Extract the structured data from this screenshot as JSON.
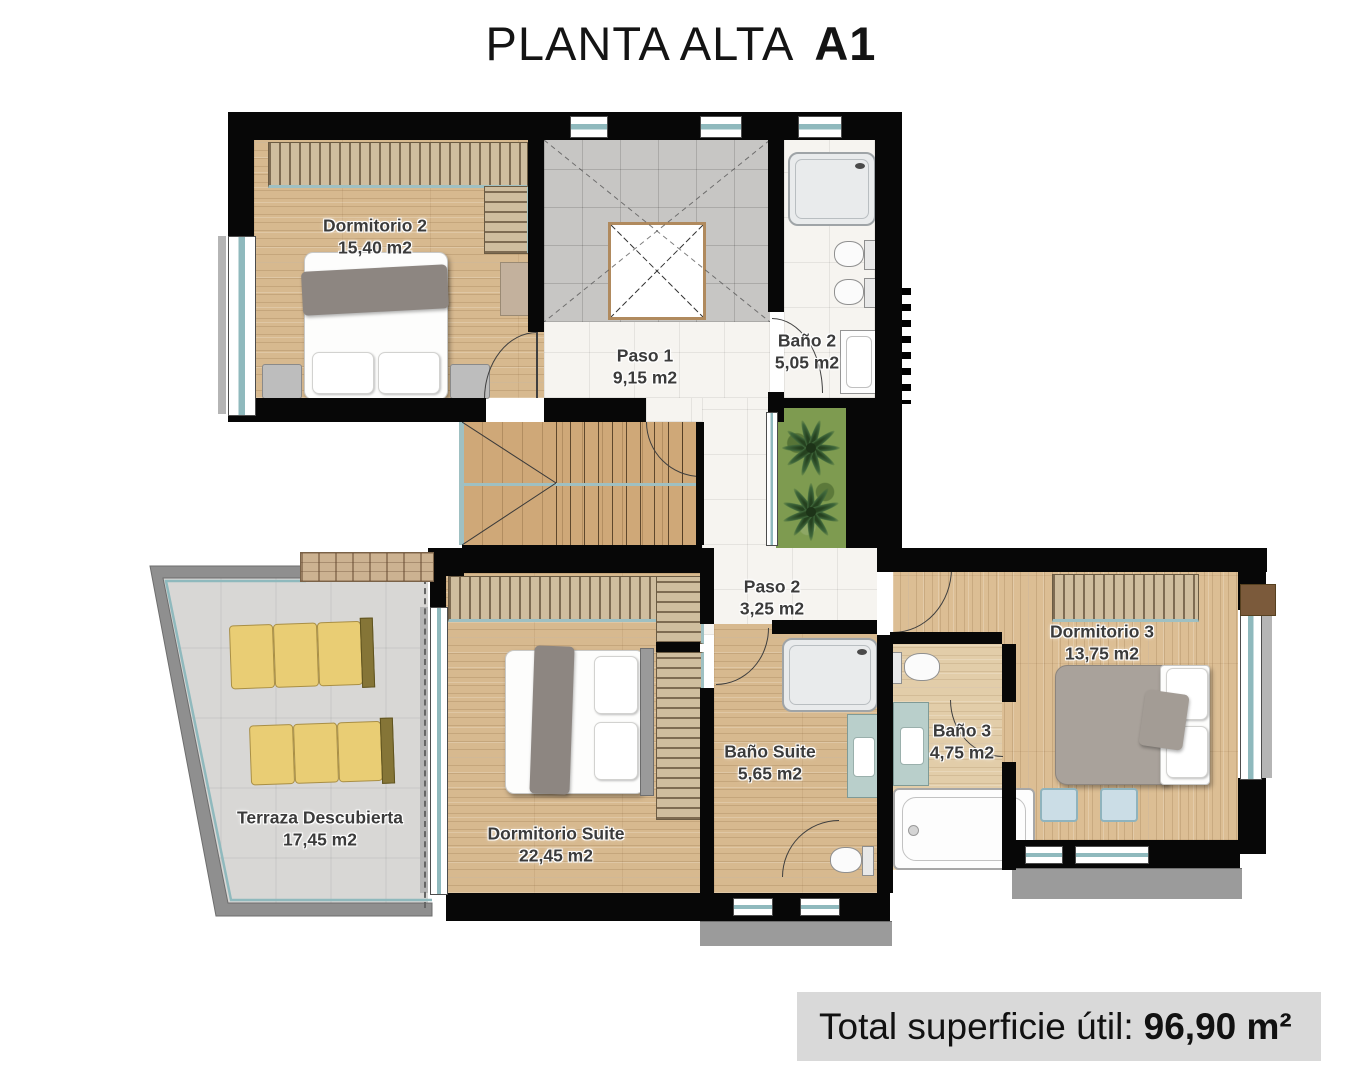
{
  "title": {
    "main": "PLANTA ALTA",
    "code": "A1"
  },
  "rooms": {
    "dormitorio2": {
      "name": "Dormitorio 2",
      "area": "15,40 m2"
    },
    "paso1": {
      "name": "Paso 1",
      "area": "9,15 m2"
    },
    "bano2": {
      "name": "Baño 2",
      "area": "5,05 m2"
    },
    "paso2": {
      "name": "Paso 2",
      "area": "3,25 m2"
    },
    "dormitorio3": {
      "name": "Dormitorio 3",
      "area": "13,75 m2"
    },
    "banoSuite": {
      "name": "Baño Suite",
      "area": "5,65 m2"
    },
    "bano3": {
      "name": "Baño 3",
      "area": "4,75 m2"
    },
    "dormitorioSuite": {
      "name": "Dormitorio Suite",
      "area": "22,45 m2"
    },
    "terraza": {
      "name": "Terraza Descubierta",
      "area": "17,45 m2"
    }
  },
  "total": {
    "label": "Total superficie útil:",
    "value": "96,90 m²"
  },
  "colors": {
    "wall": "#070707",
    "wood": "#d7b98f",
    "tile_white": "#f6f4f0",
    "tile_gray": "#c7c6c4",
    "terrace_floor": "#d8d7d5",
    "parapet": "#8f8f8f",
    "lounger": "#e9cd74",
    "grass": "#7e9b50",
    "vanity": "#b9cfcb",
    "window_frame": "#8fb9bd",
    "total_bar_bg": "#d9d9d9",
    "label_text": "#3b3b3b"
  }
}
